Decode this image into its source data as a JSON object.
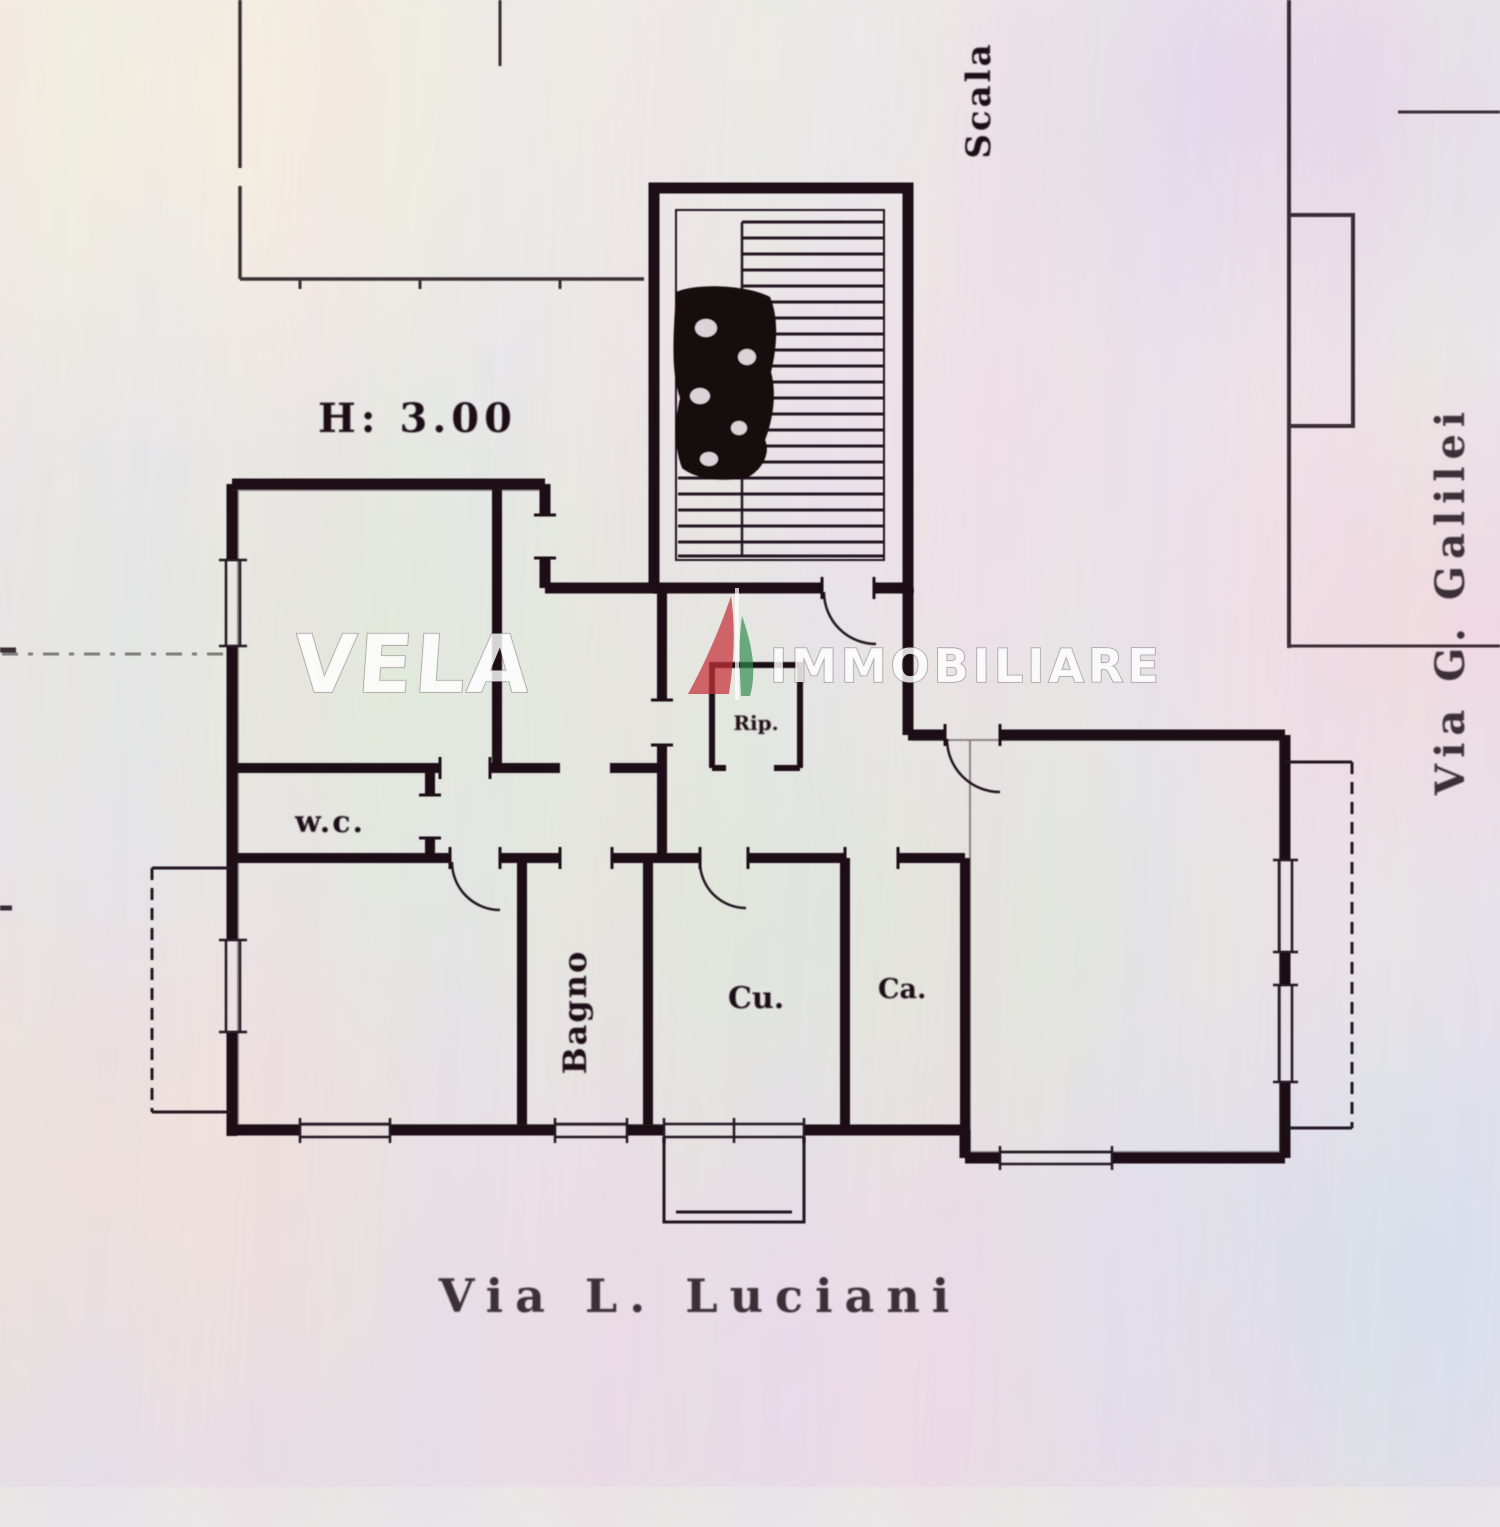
{
  "plan": {
    "type": "apartment-floor-plan",
    "height_note": "H: 3.00",
    "stair_label": "Scala",
    "rooms": [
      {
        "label": "w.c."
      },
      {
        "label": "Bagno"
      },
      {
        "label": "Cu."
      },
      {
        "label": "Ca."
      },
      {
        "label": "Rip."
      }
    ]
  },
  "streets": {
    "bottom": "Via  L.  Luciani",
    "right": "Via G. Galilei"
  },
  "watermark": {
    "primary": "VELA",
    "secondary": "IMMOBILIARE",
    "icon": "sail-icon",
    "sail_red": "#c5333a",
    "sail_green": "#2e8b4a"
  },
  "colors": {
    "ink": "#1a0f13",
    "paper": "#eceae8"
  }
}
